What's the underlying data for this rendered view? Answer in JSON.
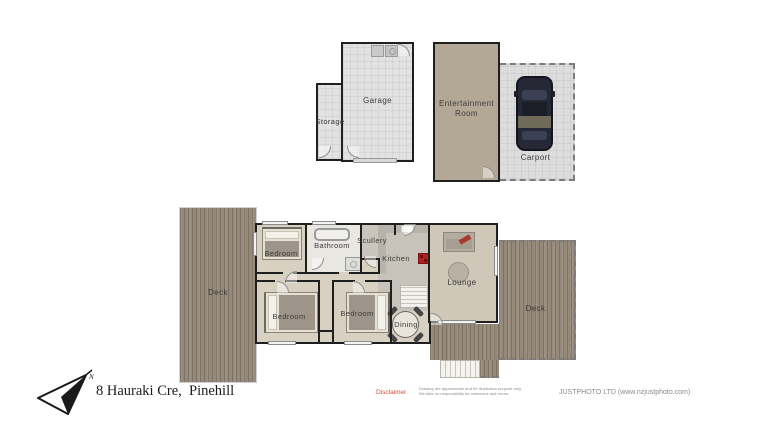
{
  "plan": {
    "rooms": {
      "garage": "Garage",
      "storage": "Storage",
      "entertainment_room": "Entertainment Room",
      "carport": "Carport",
      "bedroom_top": "Bedroom",
      "bedroom_left": "Bedroom",
      "bedroom_mid": "Bedroom",
      "bathroom": "Bathroom",
      "scullery": "Scullery",
      "kitchen": "Kitchen",
      "lounge": "Lounge",
      "dining": "Dining",
      "deck_left": "Deck",
      "deck_right": "Deck"
    },
    "compass_label": "N"
  },
  "footer": {
    "address": "8 Hauraki Cre,  Pinehill",
    "disclaimer_label": "Disclaimer",
    "disclaimer_line1": "Drawing are approximate and for illustration purpose only.",
    "disclaimer_line2": "We take no responsibility for omissions and errors.",
    "company": "JUSTPHOTO LTD (www.nzjustphoto.com)"
  },
  "colors": {
    "wall": "#1f1f1f",
    "deck_wood": "#95897a",
    "house_floor": "#d8d0c1",
    "garage_floor": "#e2e2e2",
    "entertainment_floor": "#b3a896",
    "carport_floor": "#dddddd",
    "stove_red": "#b22020",
    "disclaimer_red": "#e14a32"
  }
}
